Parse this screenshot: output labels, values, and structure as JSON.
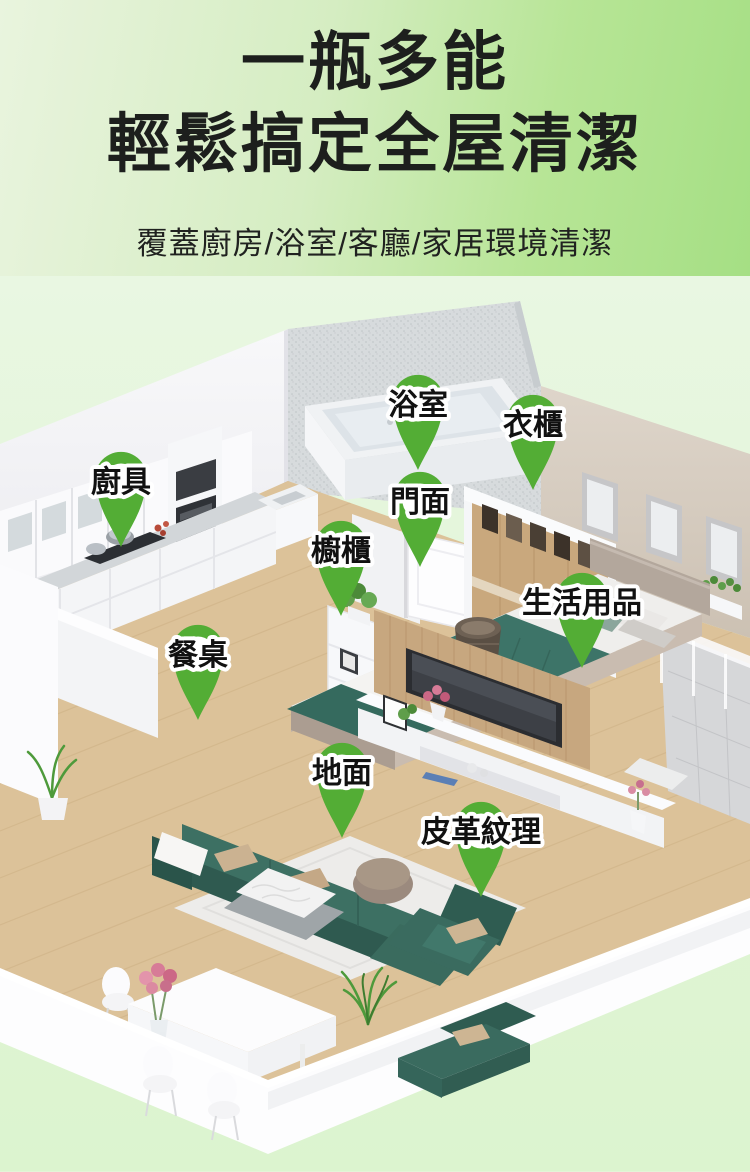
{
  "header": {
    "title_line1": "一瓶多能",
    "title_line2": "輕鬆搞定全屋清潔",
    "subtitle": "覆蓋廚房/浴室/客廳/家居環境清潔"
  },
  "pins": [
    {
      "label": "浴室"
    },
    {
      "label": "衣櫃"
    },
    {
      "label": "廚具"
    },
    {
      "label": "門面"
    },
    {
      "label": "櫥櫃"
    },
    {
      "label": "生活用品"
    },
    {
      "label": "餐桌"
    },
    {
      "label": "地面"
    },
    {
      "label": "皮革紋理"
    }
  ],
  "colors": {
    "header_bg_left": "#e9f4de",
    "header_bg_right": "#a5df84",
    "scene_bg": "#e0f5d5",
    "title_color": "#1d1f1d",
    "pin_green": "#53ad35",
    "sofa_teal": "#3d7063",
    "wood_floor": "#dcc299"
  }
}
